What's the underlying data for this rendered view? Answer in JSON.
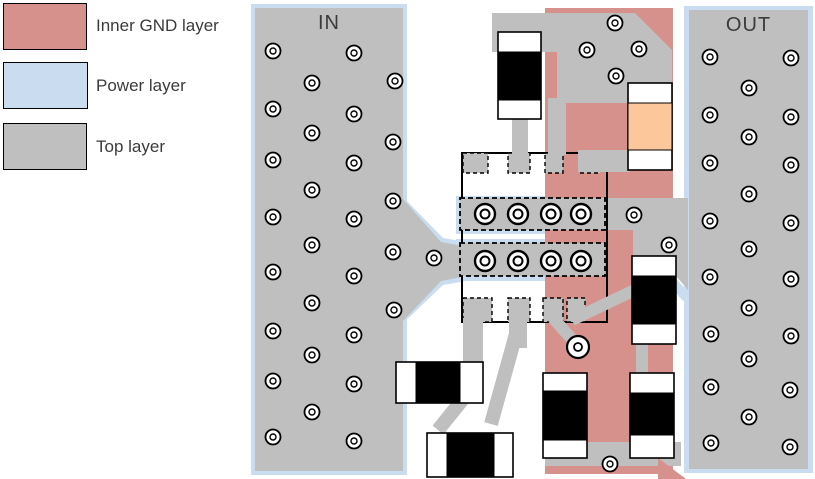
{
  "legend": {
    "items": [
      {
        "name": "inner-gnd-layer",
        "label": "Inner GND layer",
        "color": "#d6918d"
      },
      {
        "name": "power-layer",
        "label": "Power layer",
        "color": "#c9dcf0"
      },
      {
        "name": "top-layer",
        "label": "Top layer",
        "color": "#bfbfbf"
      }
    ]
  },
  "regions": {
    "in_label": "IN",
    "out_label": "OUT"
  },
  "colors": {
    "top": "#bfbfbf",
    "gnd": "#d6918d",
    "power": "#c9dcf0",
    "component_black": "#000000",
    "tantalum": "#fbc79b",
    "pad_white": "#ffffff",
    "outline": "#000000"
  },
  "board": {
    "shapes": [
      {
        "n": "in-power-outline",
        "t": "rect",
        "x": 251,
        "y": 4,
        "w": 156,
        "h": 471,
        "f": "power"
      },
      {
        "n": "out-power-outline",
        "t": "rect",
        "x": 684,
        "y": 6,
        "w": 129,
        "h": 467,
        "f": "power"
      },
      {
        "n": "in-feed-power-outline",
        "t": "poly",
        "pts": [
          [
            400,
            194
          ],
          [
            443,
            238
          ],
          [
            466,
            242
          ],
          [
            466,
            281
          ],
          [
            443,
            285
          ],
          [
            400,
            326
          ]
        ],
        "f": "power"
      },
      {
        "n": "rf-bar-top-power-outline",
        "t": "rect",
        "x": 456,
        "y": 196,
        "w": 152,
        "h": 38,
        "f": "power"
      },
      {
        "n": "rf-bar-bottom-power-outline",
        "t": "rect",
        "x": 456,
        "y": 239,
        "w": 152,
        "h": 42,
        "f": "power"
      },
      {
        "n": "bridge-power-sliver",
        "t": "poly",
        "pts": [
          [
            670,
            272
          ],
          [
            690,
            294
          ],
          [
            683,
            301
          ],
          [
            663,
            278
          ]
        ],
        "f": "power"
      },
      {
        "n": "inner-gnd-column",
        "t": "rect",
        "x": 545,
        "y": 8,
        "w": 128,
        "h": 466,
        "f": "gnd"
      },
      {
        "n": "in-top-plane",
        "t": "rect",
        "x": 255,
        "y": 8,
        "w": 148,
        "h": 463,
        "f": "top"
      },
      {
        "n": "out-top-plane",
        "t": "rect",
        "x": 689,
        "y": 10,
        "w": 119,
        "h": 459,
        "f": "top"
      },
      {
        "n": "in-feed-taper",
        "t": "poly",
        "pts": [
          [
            403,
            199
          ],
          [
            441,
            242
          ],
          [
            462,
            246
          ],
          [
            462,
            277
          ],
          [
            441,
            281
          ],
          [
            403,
            321
          ]
        ],
        "f": "top"
      },
      {
        "n": "top-copper-pour",
        "t": "poly",
        "pts": [
          [
            492,
            13
          ],
          [
            635,
            13
          ],
          [
            672,
            50
          ],
          [
            672,
            103
          ],
          [
            557,
            103
          ],
          [
            557,
            52
          ],
          [
            492,
            52
          ]
        ],
        "f": "top"
      },
      {
        "n": "out-bridge-pour",
        "t": "poly",
        "pts": [
          [
            605,
            198
          ],
          [
            688,
            198
          ],
          [
            688,
            290
          ],
          [
            676,
            276
          ],
          [
            676,
            260
          ],
          [
            633,
            260
          ],
          [
            633,
            230
          ],
          [
            605,
            230
          ]
        ],
        "f": "top"
      },
      {
        "n": "ic-courtyard-outline",
        "t": "rect",
        "x": 462,
        "y": 153,
        "w": 145,
        "h": 169,
        "f": "none",
        "s": "outline",
        "sw": 2
      },
      {
        "n": "ic-pad-top-1",
        "t": "rect",
        "x": 463,
        "y": 153,
        "w": 25,
        "h": 20,
        "f": "top",
        "s": "outline",
        "sw": 1.4,
        "dash": "4,3"
      },
      {
        "n": "ic-pad-top-2",
        "t": "rect",
        "x": 508,
        "y": 153,
        "w": 22,
        "h": 20,
        "f": "top",
        "s": "outline",
        "sw": 1.4,
        "dash": "4,3"
      },
      {
        "n": "ic-pad-top-3",
        "t": "rect",
        "x": 545,
        "y": 153,
        "w": 18,
        "h": 20,
        "f": "top",
        "s": "outline",
        "sw": 1.4,
        "dash": "4,3"
      },
      {
        "n": "ic-pad-top-4",
        "t": "rect",
        "x": 580,
        "y": 153,
        "w": 20,
        "h": 20,
        "f": "top",
        "s": "outline",
        "sw": 1.4,
        "dash": "4,3"
      },
      {
        "n": "ic-pad-bottom-1",
        "t": "rect",
        "x": 463,
        "y": 298,
        "w": 29,
        "h": 24,
        "f": "top",
        "s": "outline",
        "sw": 1.4,
        "dash": "4,3"
      },
      {
        "n": "ic-pad-bottom-2",
        "t": "rect",
        "x": 508,
        "y": 298,
        "w": 22,
        "h": 24,
        "f": "top",
        "s": "outline",
        "sw": 1.4,
        "dash": "4,3"
      },
      {
        "n": "ic-pad-bottom-3",
        "t": "rect",
        "x": 543,
        "y": 298,
        "w": 20,
        "h": 24,
        "f": "top",
        "s": "outline",
        "sw": 1.4,
        "dash": "4,3"
      },
      {
        "n": "ic-pad-bottom-4",
        "t": "rect",
        "x": 567,
        "y": 298,
        "w": 18,
        "h": 24,
        "f": "top",
        "s": "outline",
        "sw": 1.4,
        "dash": "4,3"
      },
      {
        "n": "trace-cap1-drop",
        "t": "rect",
        "x": 512,
        "y": 115,
        "w": 16,
        "h": 40,
        "f": "top"
      },
      {
        "n": "trace-pour-drop",
        "t": "rect",
        "x": 548,
        "y": 98,
        "w": 18,
        "h": 57,
        "f": "top"
      },
      {
        "n": "trace-pad4-to-tantalum",
        "t": "rect",
        "x": 578,
        "y": 150,
        "w": 52,
        "h": 22,
        "f": "top"
      },
      {
        "n": "trace-padb1-down",
        "t": "rect",
        "x": 463,
        "y": 318,
        "w": 20,
        "h": 46,
        "f": "top"
      },
      {
        "n": "trace-padb2-down",
        "t": "rect",
        "x": 509,
        "y": 318,
        "w": 18,
        "h": 30,
        "f": "top"
      },
      {
        "n": "trace-padb2-diagonal",
        "t": "line",
        "x1": 516,
        "y1": 334,
        "x2": 491,
        "y2": 424,
        "sw": 14
      },
      {
        "n": "trace-capA-to-capB-diagonal",
        "t": "line",
        "x1": 463,
        "y1": 399,
        "x2": 438,
        "y2": 430,
        "sw": 14
      },
      {
        "n": "trace-padb3-to-via",
        "t": "line",
        "x1": 553,
        "y1": 318,
        "x2": 577,
        "y2": 345,
        "sw": 12
      },
      {
        "n": "trace-padb4-diagonal",
        "t": "line",
        "x1": 572,
        "y1": 320,
        "x2": 641,
        "y2": 287,
        "sw": 12
      },
      {
        "n": "trace-capE-to-capD",
        "t": "rect",
        "x": 636,
        "y": 340,
        "w": 12,
        "h": 35,
        "f": "top"
      },
      {
        "n": "rf-bar-top",
        "t": "rect",
        "x": 460,
        "y": 198,
        "w": 145,
        "h": 32,
        "f": "top",
        "s": "outline",
        "sw": 1.8,
        "dash": "5,3"
      },
      {
        "n": "rf-bar-bottom",
        "t": "rect",
        "x": 460,
        "y": 243,
        "w": 145,
        "h": 33,
        "f": "top",
        "s": "outline",
        "sw": 1.8,
        "dash": "5,3"
      },
      {
        "n": "trace-bottom-strip",
        "t": "rect",
        "x": 545,
        "y": 442,
        "w": 136,
        "h": 24,
        "f": "top"
      },
      {
        "n": "gnd-bottom-diagonal",
        "t": "poly",
        "pts": [
          [
            658,
            458
          ],
          [
            686,
            479
          ],
          [
            658,
            479
          ]
        ],
        "f": "gnd"
      }
    ],
    "components": [
      {
        "n": "capacitor-top-left",
        "x": 498,
        "y": 32,
        "w": 43,
        "h": 87,
        "dir": "v",
        "pad": 20,
        "body": 48,
        "bodyColor": "component_black"
      },
      {
        "n": "capacitor-tantalum",
        "x": 628,
        "y": 83,
        "w": 44,
        "h": 87,
        "dir": "v",
        "pad": 20,
        "body": 47,
        "bodyColor": "tantalum"
      },
      {
        "n": "capacitor-right-upper",
        "x": 632,
        "y": 256,
        "w": 44,
        "h": 88,
        "dir": "v",
        "pad": 20,
        "body": 48,
        "bodyColor": "component_black"
      },
      {
        "n": "capacitor-center-bottom",
        "x": 543,
        "y": 373,
        "w": 44,
        "h": 85,
        "dir": "v",
        "pad": 18,
        "body": 49,
        "bodyColor": "component_black"
      },
      {
        "n": "capacitor-right-bottom",
        "x": 630,
        "y": 373,
        "w": 44,
        "h": 85,
        "dir": "v",
        "pad": 20,
        "body": 42,
        "bodyColor": "component_black"
      },
      {
        "n": "capacitor-left-horizontal",
        "x": 396,
        "y": 362,
        "w": 87,
        "h": 41,
        "dir": "h",
        "pad": 20,
        "body": 44,
        "bodyColor": "component_black"
      },
      {
        "n": "capacitor-bottom-horizontal",
        "x": 427,
        "y": 433,
        "w": 86,
        "h": 44,
        "dir": "h",
        "pad": 20,
        "body": 47,
        "bodyColor": "component_black"
      }
    ],
    "vias": {
      "small": {
        "style": {
          "r": 7.5,
          "ri": 3,
          "sw": 1.8,
          "swi": 1.4
        },
        "points": [
          [
            273,
            51
          ],
          [
            354,
            53
          ],
          [
            312,
            83
          ],
          [
            395,
            81
          ],
          [
            273,
            109
          ],
          [
            354,
            114
          ],
          [
            312,
            133
          ],
          [
            393,
            142
          ],
          [
            273,
            160
          ],
          [
            354,
            163
          ],
          [
            312,
            190
          ],
          [
            393,
            201
          ],
          [
            273,
            217
          ],
          [
            354,
            219
          ],
          [
            312,
            245
          ],
          [
            393,
            252
          ],
          [
            273,
            272
          ],
          [
            354,
            276
          ],
          [
            312,
            303
          ],
          [
            394,
            310
          ],
          [
            273,
            331
          ],
          [
            354,
            335
          ],
          [
            312,
            355
          ],
          [
            273,
            381
          ],
          [
            354,
            384
          ],
          [
            312,
            412
          ],
          [
            273,
            437
          ],
          [
            354,
            441
          ],
          [
            710,
            57
          ],
          [
            791,
            58
          ],
          [
            749,
            88
          ],
          [
            710,
            115
          ],
          [
            791,
            117
          ],
          [
            749,
            137
          ],
          [
            710,
            163
          ],
          [
            791,
            165
          ],
          [
            749,
            194
          ],
          [
            710,
            221
          ],
          [
            791,
            223
          ],
          [
            749,
            249
          ],
          [
            710,
            277
          ],
          [
            791,
            279
          ],
          [
            749,
            308
          ],
          [
            711,
            334
          ],
          [
            791,
            336
          ],
          [
            749,
            359
          ],
          [
            711,
            387
          ],
          [
            790,
            390
          ],
          [
            749,
            417
          ],
          [
            711,
            443
          ],
          [
            790,
            447
          ],
          [
            615,
            23
          ],
          [
            587,
            50
          ],
          [
            639,
            49
          ],
          [
            616,
            76
          ],
          [
            634,
            215
          ],
          [
            669,
            245
          ],
          [
            434,
            258
          ],
          [
            610,
            464
          ]
        ]
      },
      "large": {
        "style": {
          "r": 10,
          "ri": 4.5,
          "sw": 2.4,
          "swi": 2
        },
        "points": [
          [
            485,
            214
          ],
          [
            518,
            214
          ],
          [
            551,
            214
          ],
          [
            581,
            214
          ],
          [
            485,
            261
          ],
          [
            518,
            261
          ],
          [
            551,
            261
          ],
          [
            581,
            261
          ]
        ]
      },
      "medium": {
        "style": {
          "r": 11,
          "ri": 4,
          "sw": 2.2,
          "swi": 1.8
        },
        "points": [
          [
            578,
            347
          ]
        ]
      }
    }
  }
}
